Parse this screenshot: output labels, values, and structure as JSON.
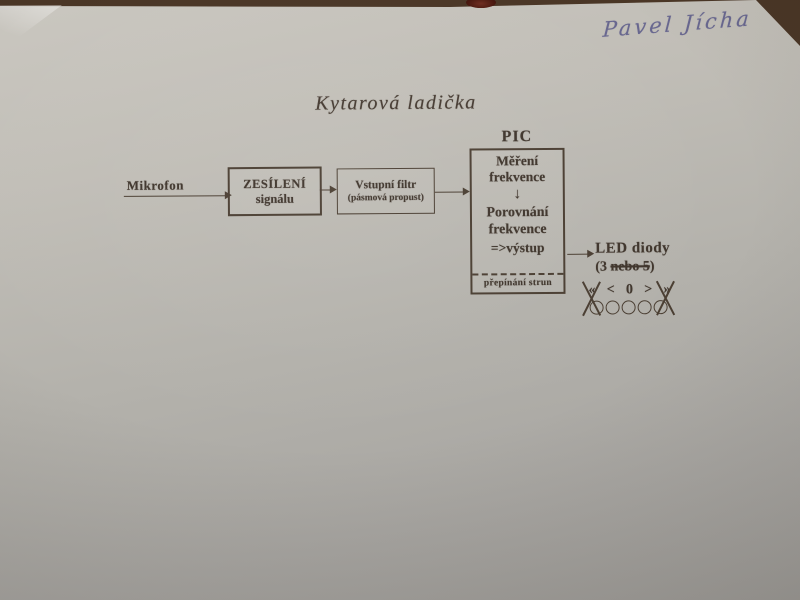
{
  "photo": {
    "handwriting": "Pavel Jícha",
    "background_color": "#4a3626",
    "paper_color": "#b8b5af",
    "ink_color": "#3f352c",
    "handwriting_color": "#62618c"
  },
  "title": "Kytarová ladička",
  "diagram": {
    "mikrofon_label": "Mikrofon",
    "amplifier_box": {
      "line1": "ZESÍLENÍ",
      "line2": "signálu"
    },
    "filter_box": {
      "line1": "Vstupní filtr",
      "line2": "(pásmová propust)"
    },
    "pic": {
      "label": "PIC",
      "step1_line1": "Měření",
      "step1_line2": "frekvence",
      "down_arrow_glyph": "↓",
      "step2_line1": "Porovnání",
      "step2_line2": "frekvence",
      "step2_line3": "=>výstup",
      "footer": "přepínání strun"
    },
    "led": {
      "label": "LED diody",
      "count_prefix": "(3 ",
      "count_struck": "nebo 5",
      "count_suffix": ")",
      "symbols": [
        "«",
        "<",
        "0",
        ">",
        "»"
      ],
      "led_count": 5
    }
  }
}
